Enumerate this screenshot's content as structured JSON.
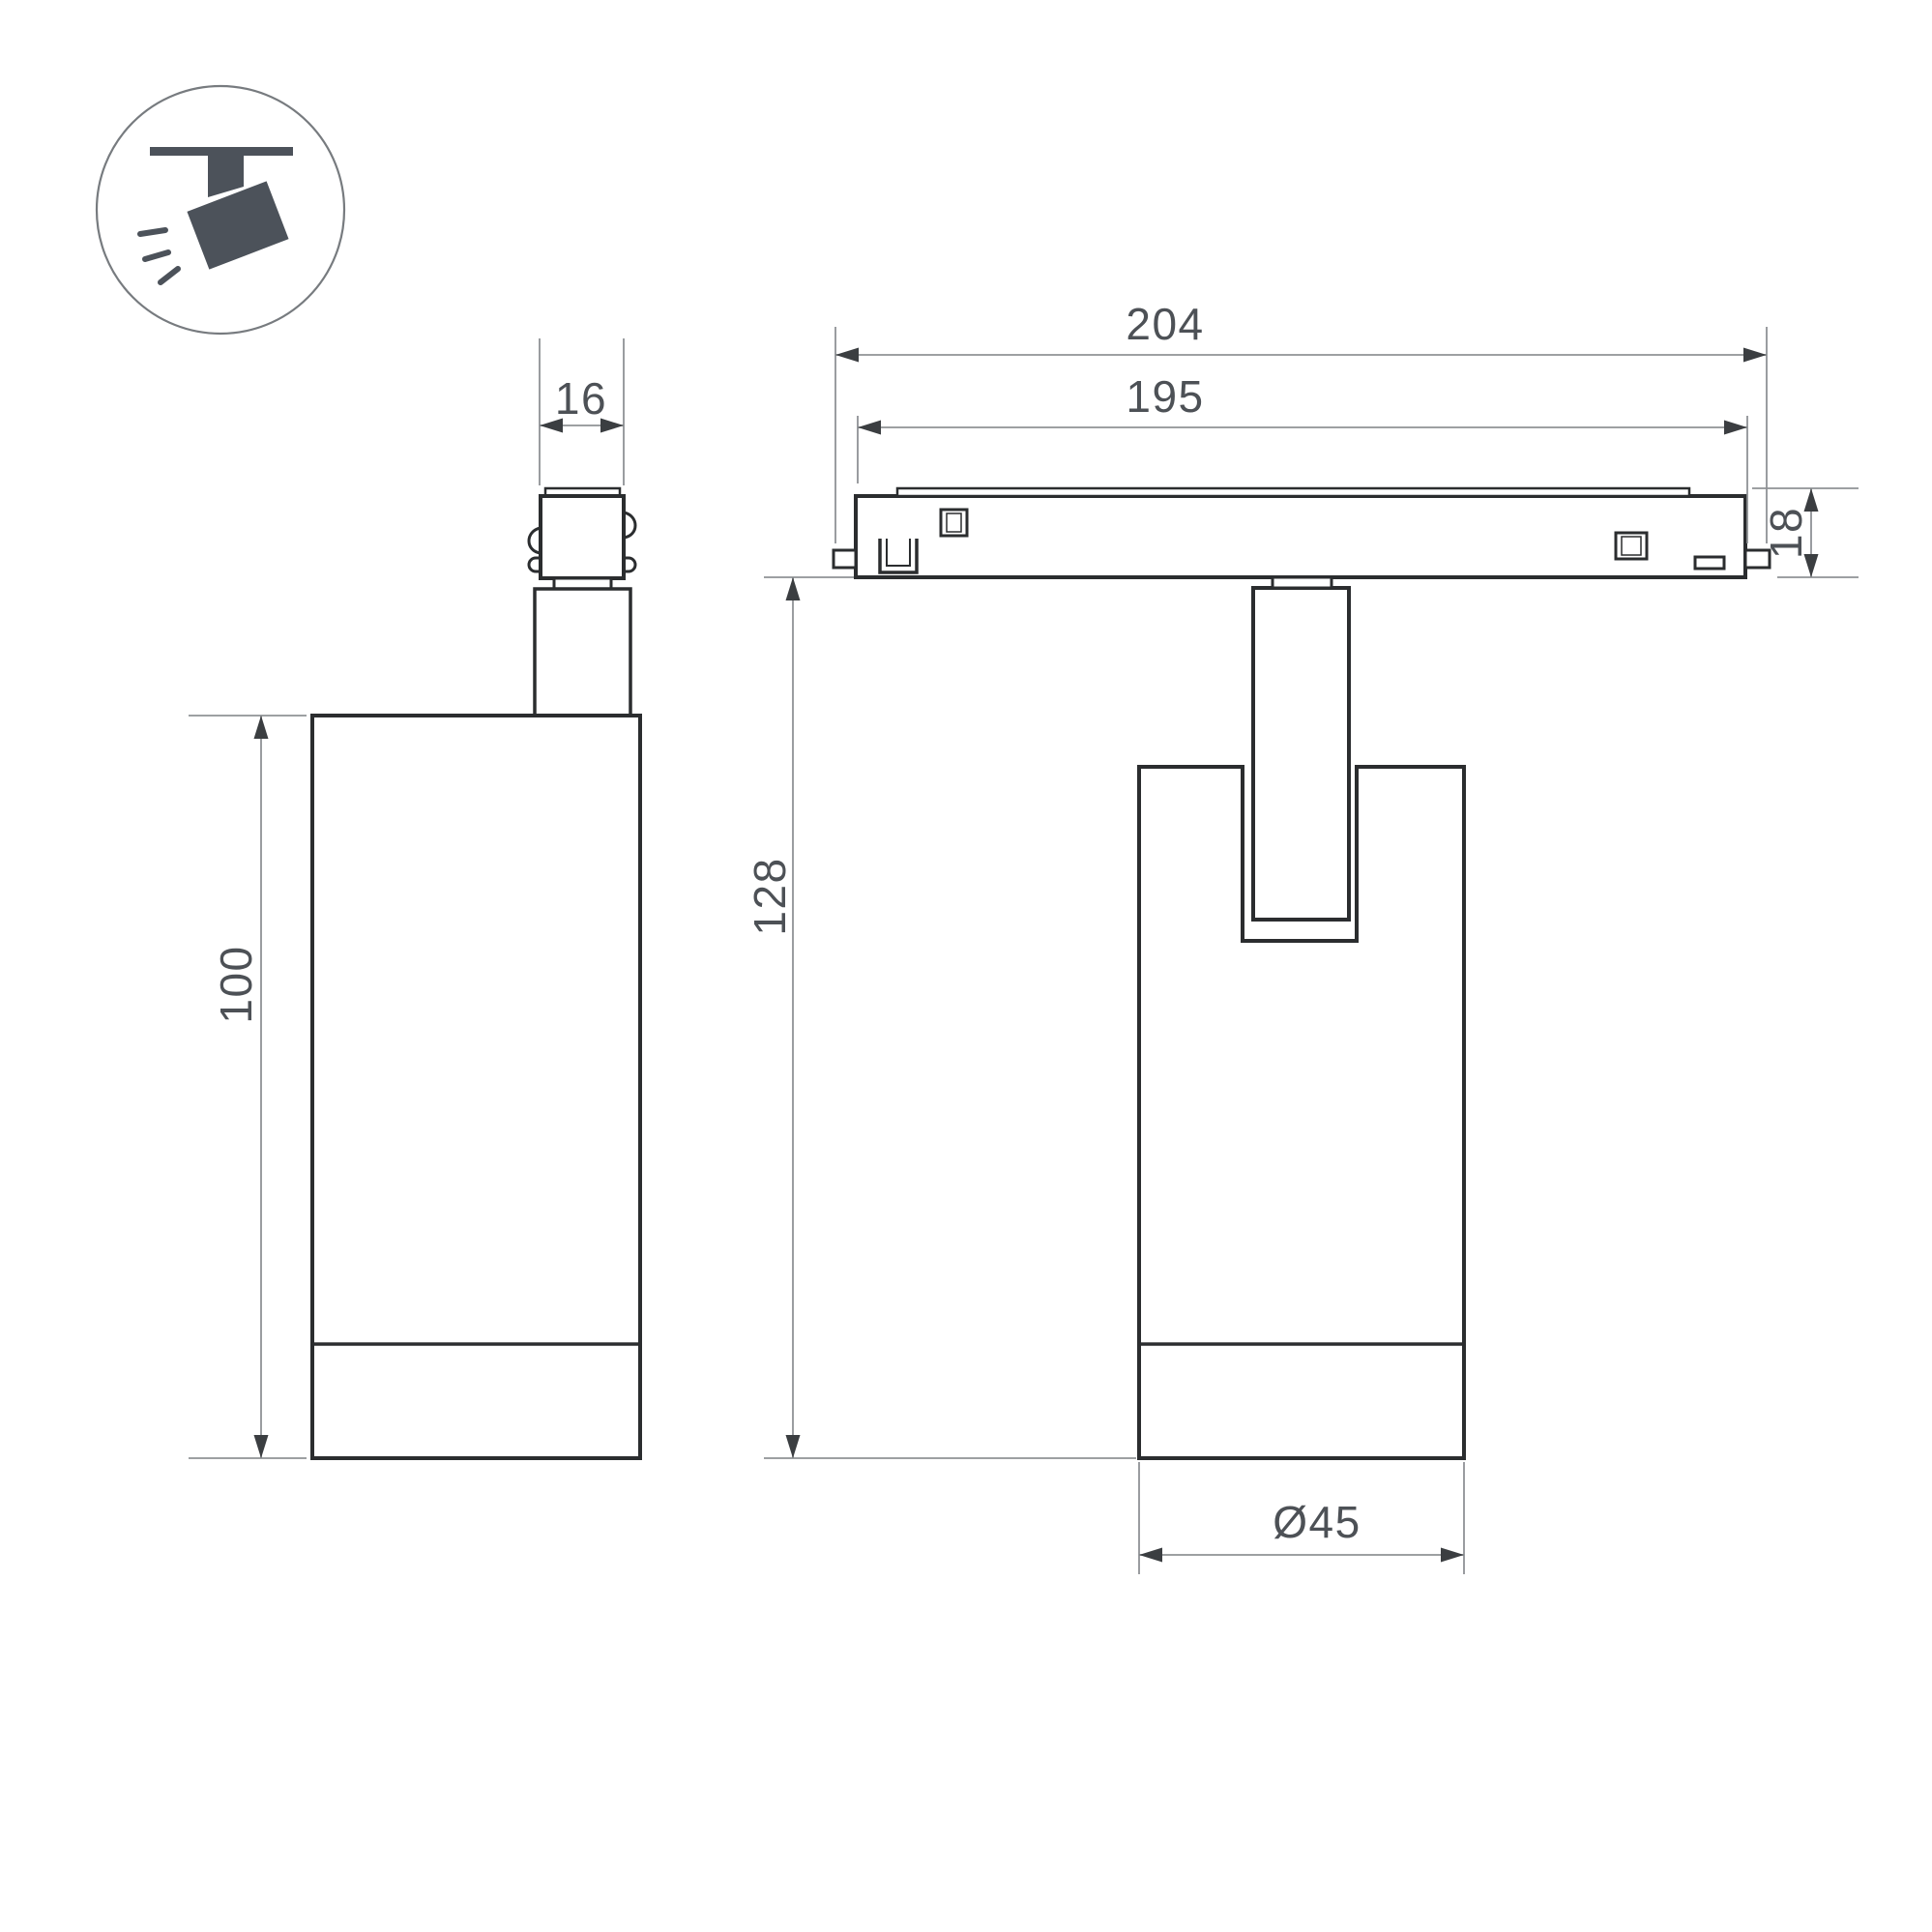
{
  "icon": {
    "name": "ceiling-track-spotlight"
  },
  "dimensions": {
    "d16": "16",
    "d100": "100",
    "d204": "204",
    "d195": "195",
    "d18": "18",
    "d128": "128",
    "d45": "Ø45"
  },
  "colors": {
    "outline": "#2B2D2F",
    "dimension_line": "#8F9295",
    "dimension_text": "#4D5156",
    "arrowhead": "#3B3E41",
    "icon": "#4C525A",
    "circle_outline": "#777B7F",
    "background": "#FFFFFF"
  }
}
